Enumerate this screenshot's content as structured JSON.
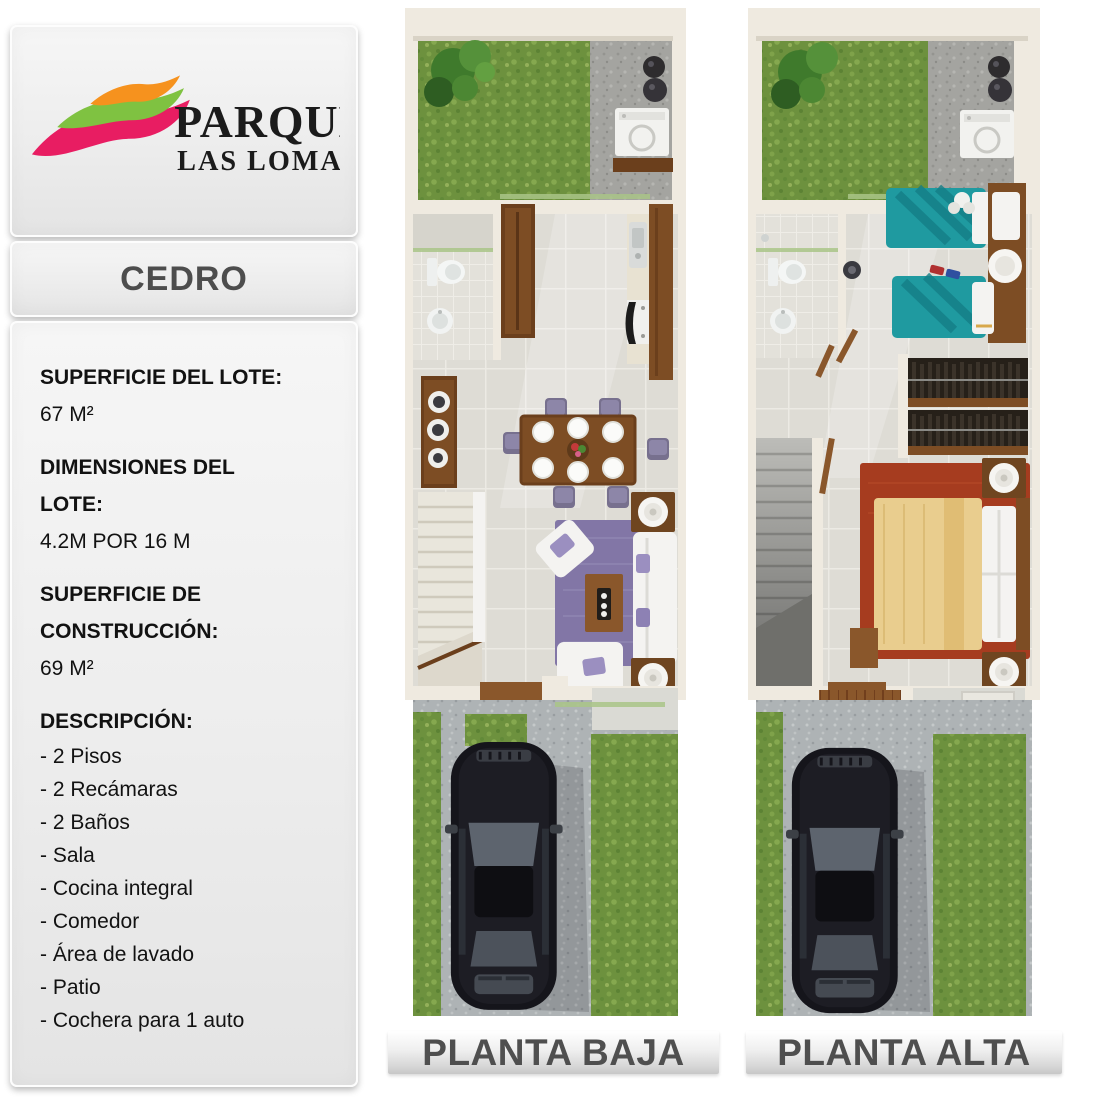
{
  "brand": {
    "name_line1": "PARQUE",
    "name_line2": "LAS LOMAS",
    "swoosh_colors": {
      "top": "#F6921E",
      "middle": "#7FC241",
      "bottom": "#E81D62"
    }
  },
  "model": {
    "name": "CEDRO"
  },
  "specs": [
    {
      "label": "SUPERFICIE DEL LOTE:",
      "value": "67 M²"
    },
    {
      "label": "DIMENSIONES DEL LOTE:",
      "value": "4.2M POR 16 M"
    },
    {
      "label": "SUPERFICIE DE CONSTRUCCIÓN:",
      "value": "69 M²"
    }
  ],
  "description": {
    "title": "DESCRIPCIÓN:",
    "items": [
      "- 2 Pisos",
      "- 2 Recámaras",
      "- 2 Baños",
      "- Sala",
      "- Cocina integral",
      "- Comedor",
      "- Área de lavado",
      "- Patio",
      "- Cochera para 1 auto"
    ]
  },
  "plans": [
    {
      "label": "PLANTA BAJA"
    },
    {
      "label": "PLANTA ALTA"
    }
  ],
  "palette": {
    "grass": "#6d913e",
    "patio_concrete": "#a4a4a0",
    "driveway_concrete": "#aeb3b5",
    "interior_tile": "#dedcd5",
    "wall": "#efeae0",
    "wood": "#7d4d24",
    "living_rug": "#8276a6",
    "sofa": "#f4f3f1",
    "kids_bed": "#1f9aa0",
    "master_rug": "#a63c1f",
    "master_duvet": "#e9cd8e",
    "car_body": "#15151b",
    "label_text": "#4f4f4f"
  }
}
